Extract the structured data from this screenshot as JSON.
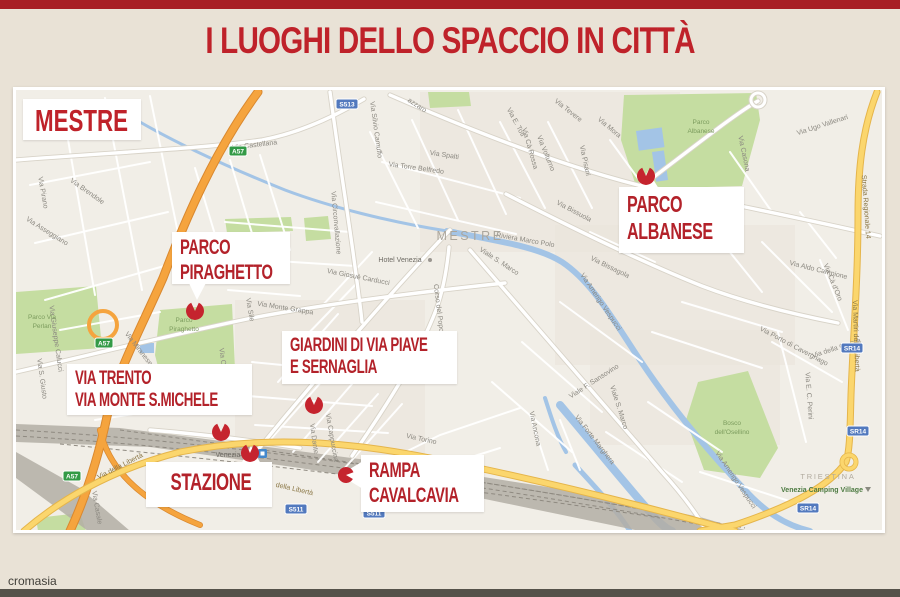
{
  "page": {
    "title": "I LUOGHI DELLO SPACCIO IN CITTÀ",
    "credit": "cromasia",
    "top_bar_color": "#a81e24",
    "bottom_bar_color": "#55524a",
    "title_color": "#bf222a",
    "background_color": "#e9e2d6"
  },
  "map": {
    "region_label": "MESTRE",
    "colors": {
      "bg": "#f1eee7",
      "urban": "#e9e4da",
      "park": "#c5dda1",
      "water": "#a3c4e6",
      "rail": "#b3aea5",
      "railHatch": "#8f8a81",
      "casing": "#d8d3c8",
      "pin": "#c5242e",
      "calloutRed": "#b3222a",
      "badgeGreen": "#339a46",
      "badgeBlue": "#5279be"
    },
    "callouts": [
      {
        "id": "parco-piraghetto",
        "lines": [
          "PARCO",
          "PIRAGHETTO"
        ],
        "x": 172,
        "y": 232,
        "w": 118,
        "h": 52,
        "fs": 21
      },
      {
        "id": "parco-albanese",
        "lines": [
          "PARCO",
          "ALBANESE"
        ],
        "x": 619,
        "y": 187,
        "w": 125,
        "h": 66,
        "fs": 23
      },
      {
        "id": "giardini-via-piave",
        "lines": [
          "GIARDINI DI VIA PIAVE",
          "E SERNAGLIA"
        ],
        "x": 282,
        "y": 331,
        "w": 175,
        "h": 53,
        "fs": 19
      },
      {
        "id": "via-trento",
        "lines": [
          "VIA TRENTO",
          "VIA MONTE S.MICHELE"
        ],
        "x": 67,
        "y": 364,
        "w": 185,
        "h": 51,
        "fs": 19
      },
      {
        "id": "stazione",
        "lines": [
          "STAZIONE"
        ],
        "x": 146,
        "y": 462,
        "w": 126,
        "h": 45,
        "fs": 24,
        "center": true
      },
      {
        "id": "rampa-cavalcavia",
        "lines": [
          "RAMPA",
          "CAVALCAVIA"
        ],
        "x": 361,
        "y": 455,
        "w": 123,
        "h": 57,
        "fs": 21
      }
    ],
    "pins": [
      [
        195,
        311,
        9,
        0
      ],
      [
        646,
        176,
        9,
        0
      ],
      [
        314,
        405,
        9,
        0
      ],
      [
        221,
        432,
        9,
        0
      ],
      [
        250,
        453,
        9,
        0
      ],
      [
        346,
        475,
        8,
        95
      ]
    ],
    "wedges": [
      "188,281 207,281 197,300",
      "637,189 659,189 648,171",
      "241,464 261,464 251,446",
      "363,461 363,489 340,475"
    ],
    "urban": [
      [
        420,
        92,
        260,
        160
      ],
      [
        555,
        225,
        240,
        140
      ],
      [
        235,
        300,
        190,
        165
      ],
      [
        590,
        330,
        190,
        115
      ]
    ],
    "parks": [
      "624,95 756,93 760,120 742,186 637,189 621,140",
      "160,310 232,304 236,390 166,398 155,355",
      "16,292 96,286 102,348 16,354",
      "698,382 748,371 778,448 760,478 704,470 686,420",
      "225,219 291,217 293,231 227,233",
      "304,218 328,216 331,239 306,241",
      "428,92 469,92 471,106 430,108",
      "36,518 80,513 86,531 38,531"
    ],
    "water": [
      [
        "M140,122 C180,145 230,168 285,190 C330,207 390,222 447,231",
        3
      ],
      [
        "M447,231 C505,242 540,248 562,262 C592,282 612,318 640,360 C668,402 705,448 745,490 C765,512 785,525 810,531",
        6
      ],
      [
        "M560,405 C588,438 620,478 650,512 C660,524 668,530 672,531",
        8
      ],
      [
        "M575,465 C600,492 618,512 630,531",
        5
      ],
      [
        "M545,398 C552,420 558,438 566,452",
        4
      ]
    ],
    "ponds": [
      [
        636,
        131,
        26,
        20,
        -8
      ],
      [
        652,
        152,
        12,
        30,
        -8
      ],
      [
        140,
        343,
        14,
        10,
        0
      ]
    ],
    "railway": {
      "bands": [
        "16,424 120,428 260,446 420,467 560,489 700,517 748,531 640,531 480,498 300,468 150,447 16,442",
        "16,452 80,488 130,531 88,531 16,478"
      ],
      "hatches": [
        "M16,430 C200,440 450,472 745,528",
        "M16,436 C200,446 450,478 730,530",
        "M120,430 C300,455 500,482 700,520",
        "M60,444 C250,462 480,490 660,518"
      ]
    },
    "roads": {
      "highway": {
        "casing": "#d9882f",
        "fill": "#f5a43e",
        "paths": [
          "M258,92 C215,150 185,220 163,278 C140,330 118,370 108,412 C100,450 88,492 70,531",
          "M100,430 C110,475 150,505 200,525"
        ]
      },
      "yellow": {
        "casing": "#e5b54b",
        "fill": "#fbd66d",
        "paths": [
          "M24,531 C60,500 110,470 180,452 C260,436 340,440 430,458 C540,480 640,505 735,531",
          "M877,92 C862,130 858,170 858,215 C858,280 853,340 851,395 C850,430 850,450 846,462 C830,485 795,505 735,525 L700,531"
        ]
      },
      "main": [
        "M16,160 C120,152 210,148 262,140 C305,132 342,112 364,99",
        "M16,372 C90,355 170,335 252,318 C330,303 420,292 505,283",
        "M256,452 C300,398 358,330 420,262 C432,249 442,238 450,230",
        "M352,456 C392,398 420,352 436,310 C443,291 447,268 449,247",
        "M470,250 C532,322 602,402 662,472 C682,494 696,513 706,530",
        "M390,95 C470,130 562,166 642,186 C722,202 800,218 880,236",
        "M506,194 C572,228 642,262 702,286 C744,302 792,314 838,323",
        "M330,92 C338,152 346,202 353,252 C357,282 360,302 362,322",
        "M642,186 C700,142 738,112 758,101",
        "M150,430 C200,434 250,440 300,448"
      ],
      "minor": [
        "M25,130 L130,112",
        "M30,185 L150,162",
        "M35,243 L168,212",
        "M45,300 L178,262",
        "M62,105 L95,295",
        "M105,98 L142,290",
        "M150,96 L188,282",
        "M60,330 L160,312",
        "M70,392 L200,370",
        "M95,420 L235,398",
        "M230,160 L260,260",
        "M195,168 L225,268",
        "M260,155 L290,250",
        "M225,222 L350,232",
        "M230,258 L355,266",
        "M228,290 L300,296",
        "M270,440 L330,372",
        "M293,452 L352,384",
        "M318,462 L378,394",
        "M343,470 L402,404",
        "M278,382 L338,314",
        "M300,342 L358,282",
        "M322,306 L372,252",
        "M252,362 L375,374",
        "M248,396 L372,406",
        "M255,425 L388,433",
        "M370,132 L418,228",
        "M412,120 L458,220",
        "M458,110 L506,214",
        "M382,162 L520,198",
        "M376,202 L516,234",
        "M500,122 L545,208",
        "M548,122 L592,208",
        "M590,232 L655,262",
        "M610,140 L650,195",
        "M660,200 L720,250",
        "M700,215 L762,292",
        "M730,152 L772,212",
        "M762,242 L832,312",
        "M682,302 L782,332",
        "M652,332 L762,368",
        "M772,342 L842,382",
        "M560,302 L642,362",
        "M522,342 L602,412",
        "M492,382 L572,452",
        "M606,432 L682,482",
        "M648,402 L722,452",
        "M700,472 L792,502",
        "M778,332 L806,442",
        "M820,260 L848,330",
        "M800,212 L836,258",
        "M385,462 L440,435 L520,408",
        "M430,470 L500,448",
        "M530,415 L548,470",
        "M560,420 L580,470"
      ]
    },
    "labelStyles": {
      "g": {
        "fill": "#8b8880",
        "size": 7
      },
      "d": {
        "fill": "#6e6b64",
        "size": 7
      },
      "y": {
        "fill": "#8a7645",
        "size": 7
      },
      "w": {
        "fill": "#aba69c",
        "size": 12.5,
        "ls": 2.5
      },
      "t": {
        "fill": "#b1ab9f",
        "size": 7.5,
        "ls": 1.8
      },
      "c": {
        "fill": "#4e7b43",
        "size": 7,
        "w": 700
      },
      "p": {
        "fill": "#7c9c5e",
        "size": 6.5
      }
    },
    "street_labels": [
      [
        "Via Castellana",
        255,
        147,
        -7
      ],
      [
        "azzaro",
        416,
        107,
        33
      ],
      [
        "Via Silvio Camuffo",
        374,
        130,
        82
      ],
      [
        "Via Spalti",
        444,
        157,
        9
      ],
      [
        "Via Torre Belfredo",
        416,
        170,
        8
      ],
      [
        "Via E. Toti",
        514,
        123,
        62
      ],
      [
        "Via Cà Rossa",
        528,
        149,
        74
      ],
      [
        "Via Tevere",
        567,
        112,
        38
      ],
      [
        "Via Volturno",
        544,
        154,
        68
      ],
      [
        "Via Pisani",
        583,
        161,
        78
      ],
      [
        "Via Mora",
        608,
        129,
        40
      ],
      [
        "Via Ugo Vallenari",
        823,
        127,
        -18
      ],
      [
        "Via Casona",
        742,
        154,
        78
      ],
      [
        "Via Porto di Cavergnago",
        793,
        348,
        28
      ],
      [
        "Via Cà d'Oro",
        831,
        283,
        68
      ],
      [
        "Via Aldo Campione",
        818,
        272,
        14
      ],
      [
        "Via E. C. Perini",
        807,
        396,
        86
      ],
      [
        "Via della Crosca",
        837,
        350,
        -18
      ],
      [
        "Via Bissuola",
        573,
        213,
        28
      ],
      [
        "Via Bissagola",
        609,
        269,
        26
      ],
      [
        "Riviera Marco Polo",
        525,
        242,
        10
      ],
      [
        "Via Amerigo Vespucci",
        599,
        303,
        56
      ],
      [
        "Via Amerigo Vespucci",
        734,
        481,
        56
      ],
      [
        "Viale S. Marco",
        498,
        263,
        33
      ],
      [
        "Viale S. Marco",
        617,
        408,
        72
      ],
      [
        "Viale F. Sansovino",
        595,
        383,
        -33
      ],
      [
        "Via Forte Marghera",
        593,
        441,
        52
      ],
      [
        "Via Torino",
        421,
        441,
        12
      ],
      [
        "Via Torino",
        464,
        478,
        82
      ],
      [
        "Corso del Popolo",
        437,
        311,
        83
      ],
      [
        "Via Circonvallazione",
        334,
        223,
        85
      ],
      [
        "Via Giosuè Carducci",
        358,
        279,
        11
      ],
      [
        "Via Monte Grappa",
        285,
        310,
        9
      ],
      [
        "Via Sile",
        248,
        310,
        80
      ],
      [
        "Via Olivi",
        221,
        361,
        82
      ],
      [
        "Via Miranese",
        137,
        350,
        52
      ],
      [
        "Via Brendole",
        86,
        193,
        35
      ],
      [
        "Via Pirano",
        41,
        193,
        80
      ],
      [
        "Via Asseggiano",
        46,
        233,
        32
      ],
      [
        "Via S. Giusto",
        40,
        379,
        82
      ],
      [
        "Via Giuseppe Calucci",
        54,
        339,
        82
      ],
      [
        "Via Dante",
        312,
        439,
        82
      ],
      [
        "Via Cappuccina",
        330,
        438,
        80
      ],
      [
        "Via Ancona",
        533,
        429,
        78
      ],
      [
        "Via Casale",
        95,
        508,
        80
      ],
      [
        "Hotel Venezia",
        400,
        262,
        0,
        "d"
      ],
      [
        "Venezia",
        228,
        457,
        0,
        "d"
      ],
      [
        "Strada Regionale 14",
        864,
        207,
        86,
        "y"
      ],
      [
        "Via Martiri della Libertà",
        854,
        336,
        88,
        "y"
      ],
      [
        "Via della Libertà",
        121,
        468,
        -27,
        "y"
      ],
      [
        "della Libertà",
        294,
        491,
        13,
        "y"
      ],
      [
        "MESTRE",
        470,
        240,
        0,
        "w"
      ],
      [
        "TRIESTINA",
        828,
        479,
        0,
        "t"
      ],
      [
        "Venezia Camping Village",
        822,
        492,
        0,
        "c"
      ],
      [
        "Parco",
        701,
        124,
        0,
        "p"
      ],
      [
        "Albanese",
        701,
        133,
        0,
        "p"
      ],
      [
        "Parco",
        184,
        322,
        0,
        "p"
      ],
      [
        "Piraghetto",
        184,
        331,
        0,
        "p"
      ],
      [
        "Parco Via",
        42,
        319,
        0,
        "p"
      ],
      [
        "Perlan",
        42,
        328,
        0,
        "p"
      ],
      [
        "Bosco",
        732,
        425,
        0,
        "p"
      ],
      [
        "dell'Osellino",
        732,
        434,
        0,
        "p"
      ]
    ],
    "badges": [
      [
        "A57",
        238,
        151,
        "g"
      ],
      [
        "A57",
        104,
        343,
        "g"
      ],
      [
        "A57",
        72,
        476,
        "g"
      ],
      [
        "S513",
        347,
        104,
        "b"
      ],
      [
        "S511",
        296,
        509,
        "b"
      ],
      [
        "S511",
        374,
        513,
        "b"
      ],
      [
        "SR14",
        852,
        348,
        "b"
      ],
      [
        "SR14",
        858,
        431,
        "b"
      ],
      [
        "SR14",
        808,
        508,
        "b"
      ]
    ]
  }
}
